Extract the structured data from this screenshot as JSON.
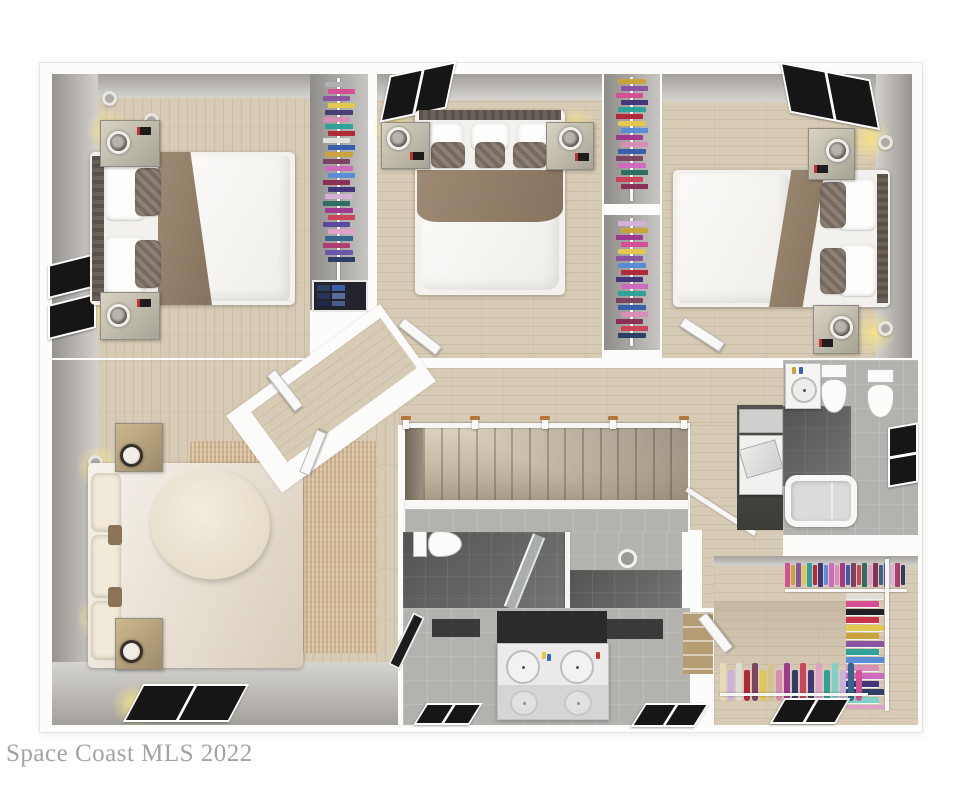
{
  "watermark": {
    "text": "Space Coast MLS 2022"
  },
  "palette": {
    "wood": "#d8cbb5",
    "rug": "#d9c5aa",
    "floor_gray": "#b3b2af",
    "window_pane": "#161616",
    "post_wood": "#b5763a",
    "blanket_taupe": "#94816b",
    "duvet_white": "#f7f6f3",
    "cream_bedding": "#ebe3d4",
    "glow_yellow": "#f6e487"
  },
  "stairs": {
    "tread_count": 15
  },
  "closets": {
    "br1_rail": [
      "#b0b0b2",
      "#d44f93",
      "#8a56a0",
      "#e2c84e",
      "#4a3f72",
      "#d98fb5",
      "#2fa39a",
      "#b02a3a",
      "#e3e1de",
      "#3b5ea8",
      "#c9a43b",
      "#7c4462",
      "#cf6bbf",
      "#5b8dd6",
      "#8b2f56",
      "#43367a",
      "#d4b2d8",
      "#2f6e63",
      "#9e3a8f",
      "#cc4458",
      "#5a4a9e",
      "#e0a1c6",
      "#36648b",
      "#ad3f70",
      "#6b56a8",
      "#2e3f66"
    ],
    "br1_shelf": [
      "#2e3f66",
      "#3b5ea8",
      "#27355a",
      "#5a6b9e",
      "#1f2a47",
      "#4a5d8f"
    ],
    "br2_rail": [
      "#c9a43b",
      "#8a56a0",
      "#d44f93",
      "#43367a",
      "#2fa39a",
      "#b02a3a",
      "#e2c84e",
      "#5b8dd6",
      "#9e3a8f",
      "#d98fb5",
      "#3b5ea8",
      "#7c4462",
      "#cf6bbf",
      "#2f6e63",
      "#cc4458",
      "#8b2f56"
    ],
    "br3_rail": [
      "#d4b2d8",
      "#c9a43b",
      "#9e3a8f",
      "#d44f93",
      "#e2c84e",
      "#8a56a0",
      "#5b8dd6",
      "#b02a3a",
      "#43367a",
      "#cf6bbf",
      "#2fa39a",
      "#7c4462",
      "#3b5ea8",
      "#d98fb5",
      "#8b2f56",
      "#cc4458",
      "#2e3f66"
    ],
    "walkin_top": [
      "#d44f93",
      "#c9a43b",
      "#8a56a0",
      "#e2c84e",
      "#2fa39a",
      "#b02a3a",
      "#43367a",
      "#5b8dd6",
      "#cf6bbf",
      "#d98fb5",
      "#9e3a8f",
      "#3b5ea8",
      "#7c4462",
      "#cc4458",
      "#2f6e63",
      "#e0a1c6",
      "#8b2f56",
      "#36648b",
      "#6b56a8",
      "#d4b2d8",
      "#ad3f70",
      "#2e3f66"
    ],
    "walkin_side": [
      "#e0dcd6",
      "#d44f93",
      "#1f1f24",
      "#c9324b",
      "#e2c84e",
      "#caa43b",
      "#8a56a0",
      "#2fa39a",
      "#5b8dd6",
      "#d98fb5",
      "#cf6bbf",
      "#43367a",
      "#2e3f66",
      "#7fd1c8",
      "#e0a1c6",
      "#3b5ea8"
    ],
    "walkin_bottom": [
      "#e8d9b8",
      "#c9b2dd",
      "#e0dcd6",
      "#b02a3a",
      "#7c4462",
      "#e2c84e",
      "#d4c590",
      "#d98fb5",
      "#9e3a8f",
      "#2e3f66",
      "#cc4458",
      "#43367a",
      "#e0a1c6",
      "#2fa39a",
      "#7fd1c8",
      "#c9b2dd",
      "#36648b",
      "#d44f93"
    ]
  }
}
